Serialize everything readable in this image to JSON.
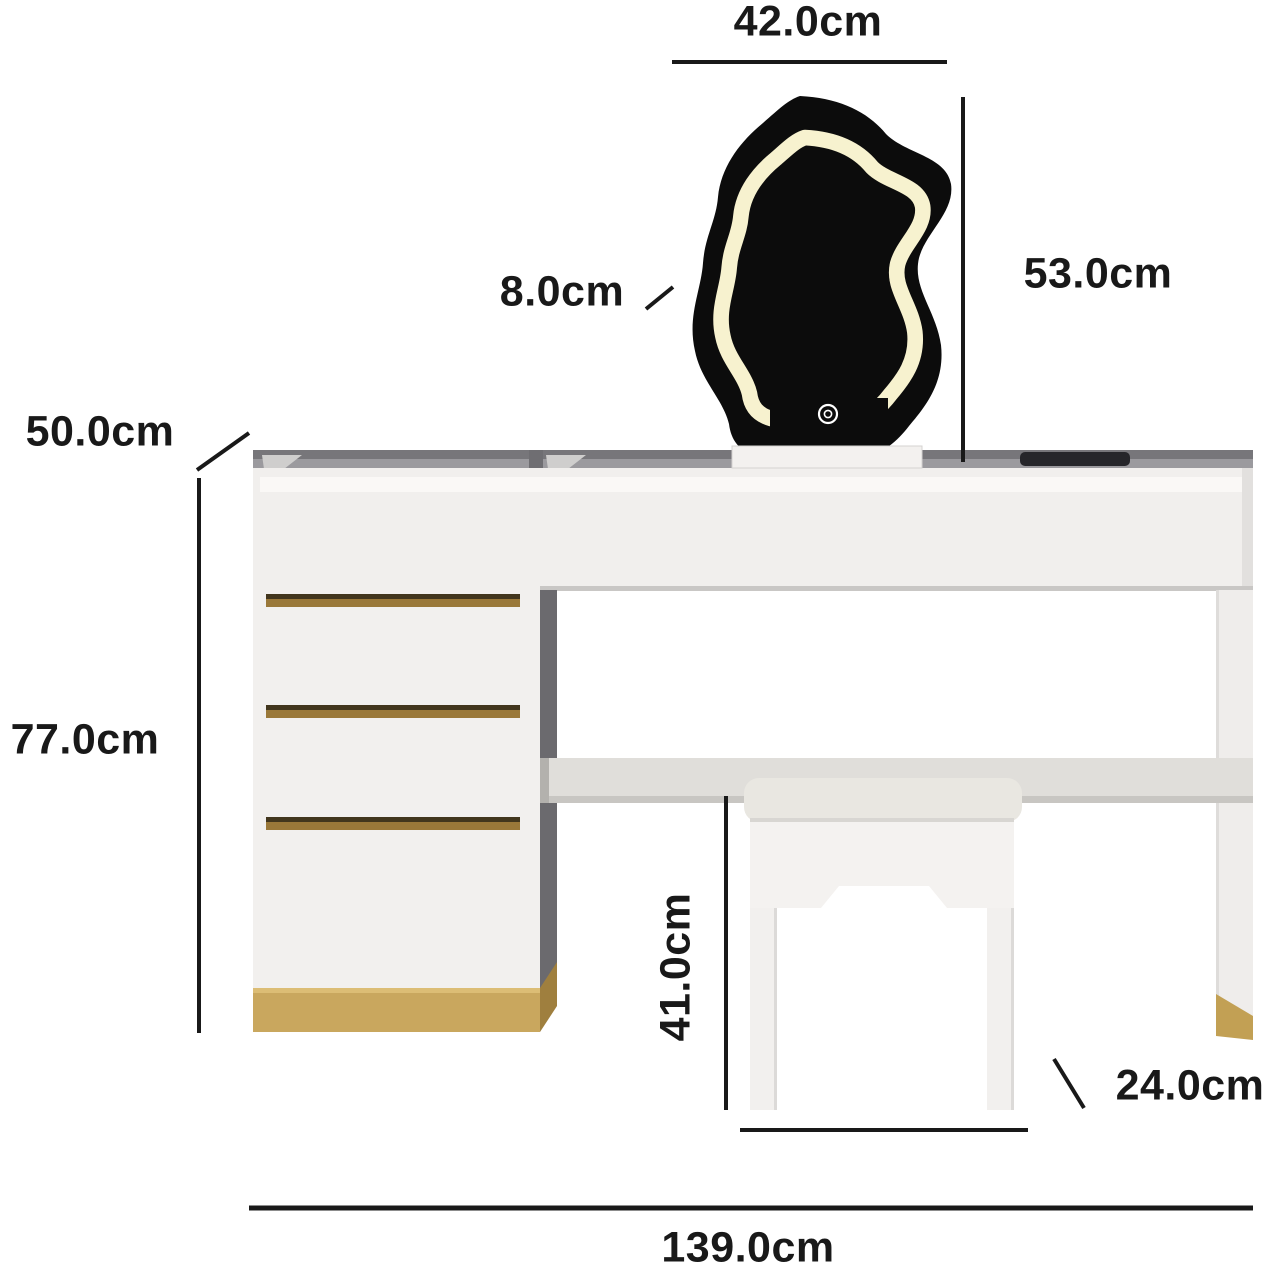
{
  "diagram": {
    "kind": "product-dimension-diagram",
    "product": "vanity dressing table with wavy LED mirror, drawer chest and stool"
  },
  "dimensions": {
    "mirror_width": "42.0cm",
    "mirror_height": "53.0cm",
    "mirror_depth": "8.0cm",
    "desk_depth": "50.0cm",
    "desk_height": "77.0cm",
    "stool_height": "41.0cm",
    "stool_depth": "24.0cm",
    "desk_width": "139.0cm"
  },
  "icons": {
    "mirror_touch_button": "power-touch-icon"
  },
  "colors": {
    "annotation": "#191919",
    "mirror_frame": "#0c0c0c",
    "led_strip": "#f7f2cf",
    "furniture_white": "#f1efed",
    "cushion_white": "#e9e7e1",
    "top_edge_gray": "#77767a",
    "gold_accent": "#c9a75e",
    "drawer_slot_gold": "#9a7839",
    "charging_pad_black": "#26262a"
  }
}
